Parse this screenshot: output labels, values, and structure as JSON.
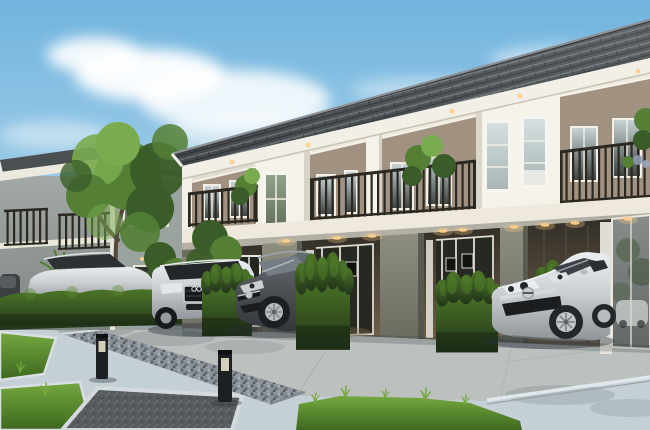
{
  "scene": {
    "description": "Daylight 3D architectural rendering of a modern two-storey townhouse row with dark tiled roof, cream upper walls, taupe window panels, dark metal balconies with plants, recessed sage-green ground-floor porches with warm downlights, parked cars (silver SUV, dark grey hatchback, silver coupe, silver sedan), clipped hedge blocks, a large tree, grey background house, concrete driveway, bluish paved walkway with grass patches, gravel strip and two black bollard lights under a blue sky with soft clouds",
    "objects": [
      "sky",
      "clouds",
      "background-house",
      "background-gable-house",
      "large-tree",
      "shrubs",
      "townhouse-row",
      "tiled-roof",
      "roof-fascia",
      "upper-wall",
      "taupe-panel",
      "stair-bay",
      "upstairs-window",
      "balcony-railing",
      "balcony-plant",
      "balcony-band",
      "ground-floor",
      "porch",
      "glass-door",
      "curtain",
      "picture-frame",
      "downlight",
      "eave-light",
      "glass-wall",
      "hedge-row",
      "hedge-block",
      "silver-sedan",
      "silver-suv",
      "dark-hatchback",
      "silver-coupe",
      "driveway",
      "walkway",
      "curb",
      "gravel-strip",
      "bollard-light",
      "grass-patch",
      "stone-paver"
    ]
  },
  "palette": {
    "sky_top": "#71b4de",
    "sky_mid": "#a9d2ea",
    "sky_horizon": "#e8f3f9",
    "cloud": "#ffffff",
    "roof_dark": "#42474b",
    "roof_highlight": "#8b9196",
    "fascia_white": "#f2efe6",
    "wall_cream": "#eee8dc",
    "wall_taupe": "#a19180",
    "bay_white": "#f5f2ea",
    "railing": "#2b2822",
    "balcony_band": "#efe9dd",
    "ground_sage": "#8e8f80",
    "ground_sage_dark": "#6b6c60",
    "porch_dark": "#332f28",
    "porch_warm": "#6e6049",
    "downlight": "#ffce8a",
    "window_glass_dark": "#3e4440",
    "glass_sky": "#c6d2d4",
    "curtain": "#e9e6df",
    "hedge_top": "#4c7527",
    "hedge_dark": "#22351a",
    "hedge_light": "#58892e",
    "tree_dark": "#3a5c28",
    "tree_mid": "#547f35",
    "tree_light": "#7aab4e",
    "trunk": "#53463a",
    "grass_dark": "#3e681f",
    "grass_light": "#74a83f",
    "driveway": "#bcc0bf",
    "walkway": "#c5d0d6",
    "walkway_edge": "#e0e8ec",
    "gravel": "#8b9298",
    "paver": "#565b5d",
    "bollard": "#1d2022",
    "car_silver": "#ccd0d3",
    "car_silver_shadow": "#8f959a",
    "car_dark": "#4a4f53",
    "bg_house_wall": "#a3a9a6",
    "shadow": "#273036"
  }
}
